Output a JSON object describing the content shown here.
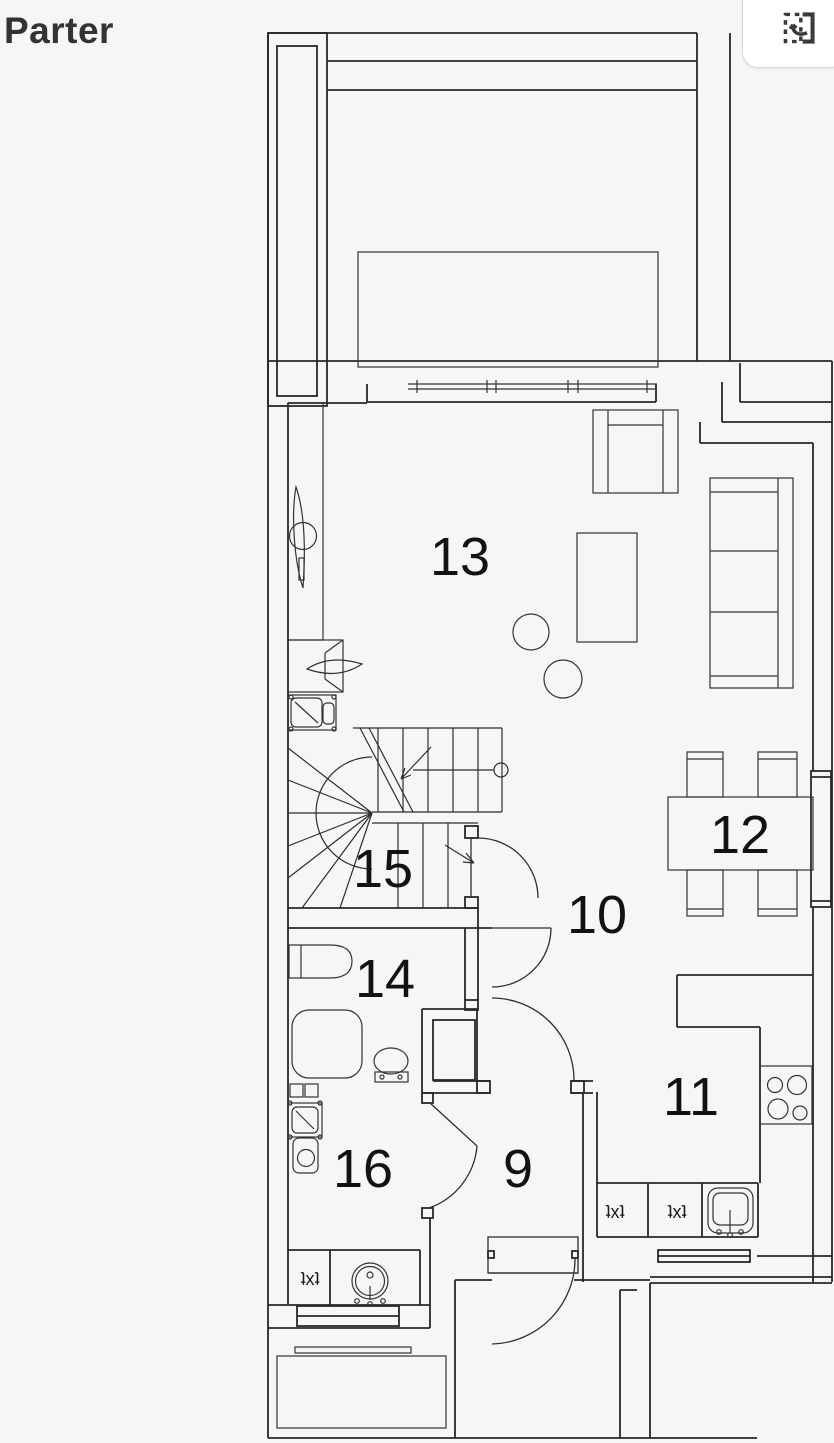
{
  "page": {
    "background": "#f6f6f7",
    "line_color": "#282828"
  },
  "header": {
    "title": "Parter"
  },
  "toolbar": {
    "flip_button_icon": "flip-rotate-icon"
  },
  "floorplan": {
    "rooms": [
      {
        "number": "9"
      },
      {
        "number": "10"
      },
      {
        "number": "11"
      },
      {
        "number": "12"
      },
      {
        "number": "13"
      },
      {
        "number": "14"
      },
      {
        "number": "15"
      },
      {
        "number": "16"
      }
    ],
    "fixture_labels": [
      {
        "text": "ʇxʇ"
      },
      {
        "text": "ʇxʇ"
      },
      {
        "text": "ʇxʇ"
      }
    ]
  }
}
